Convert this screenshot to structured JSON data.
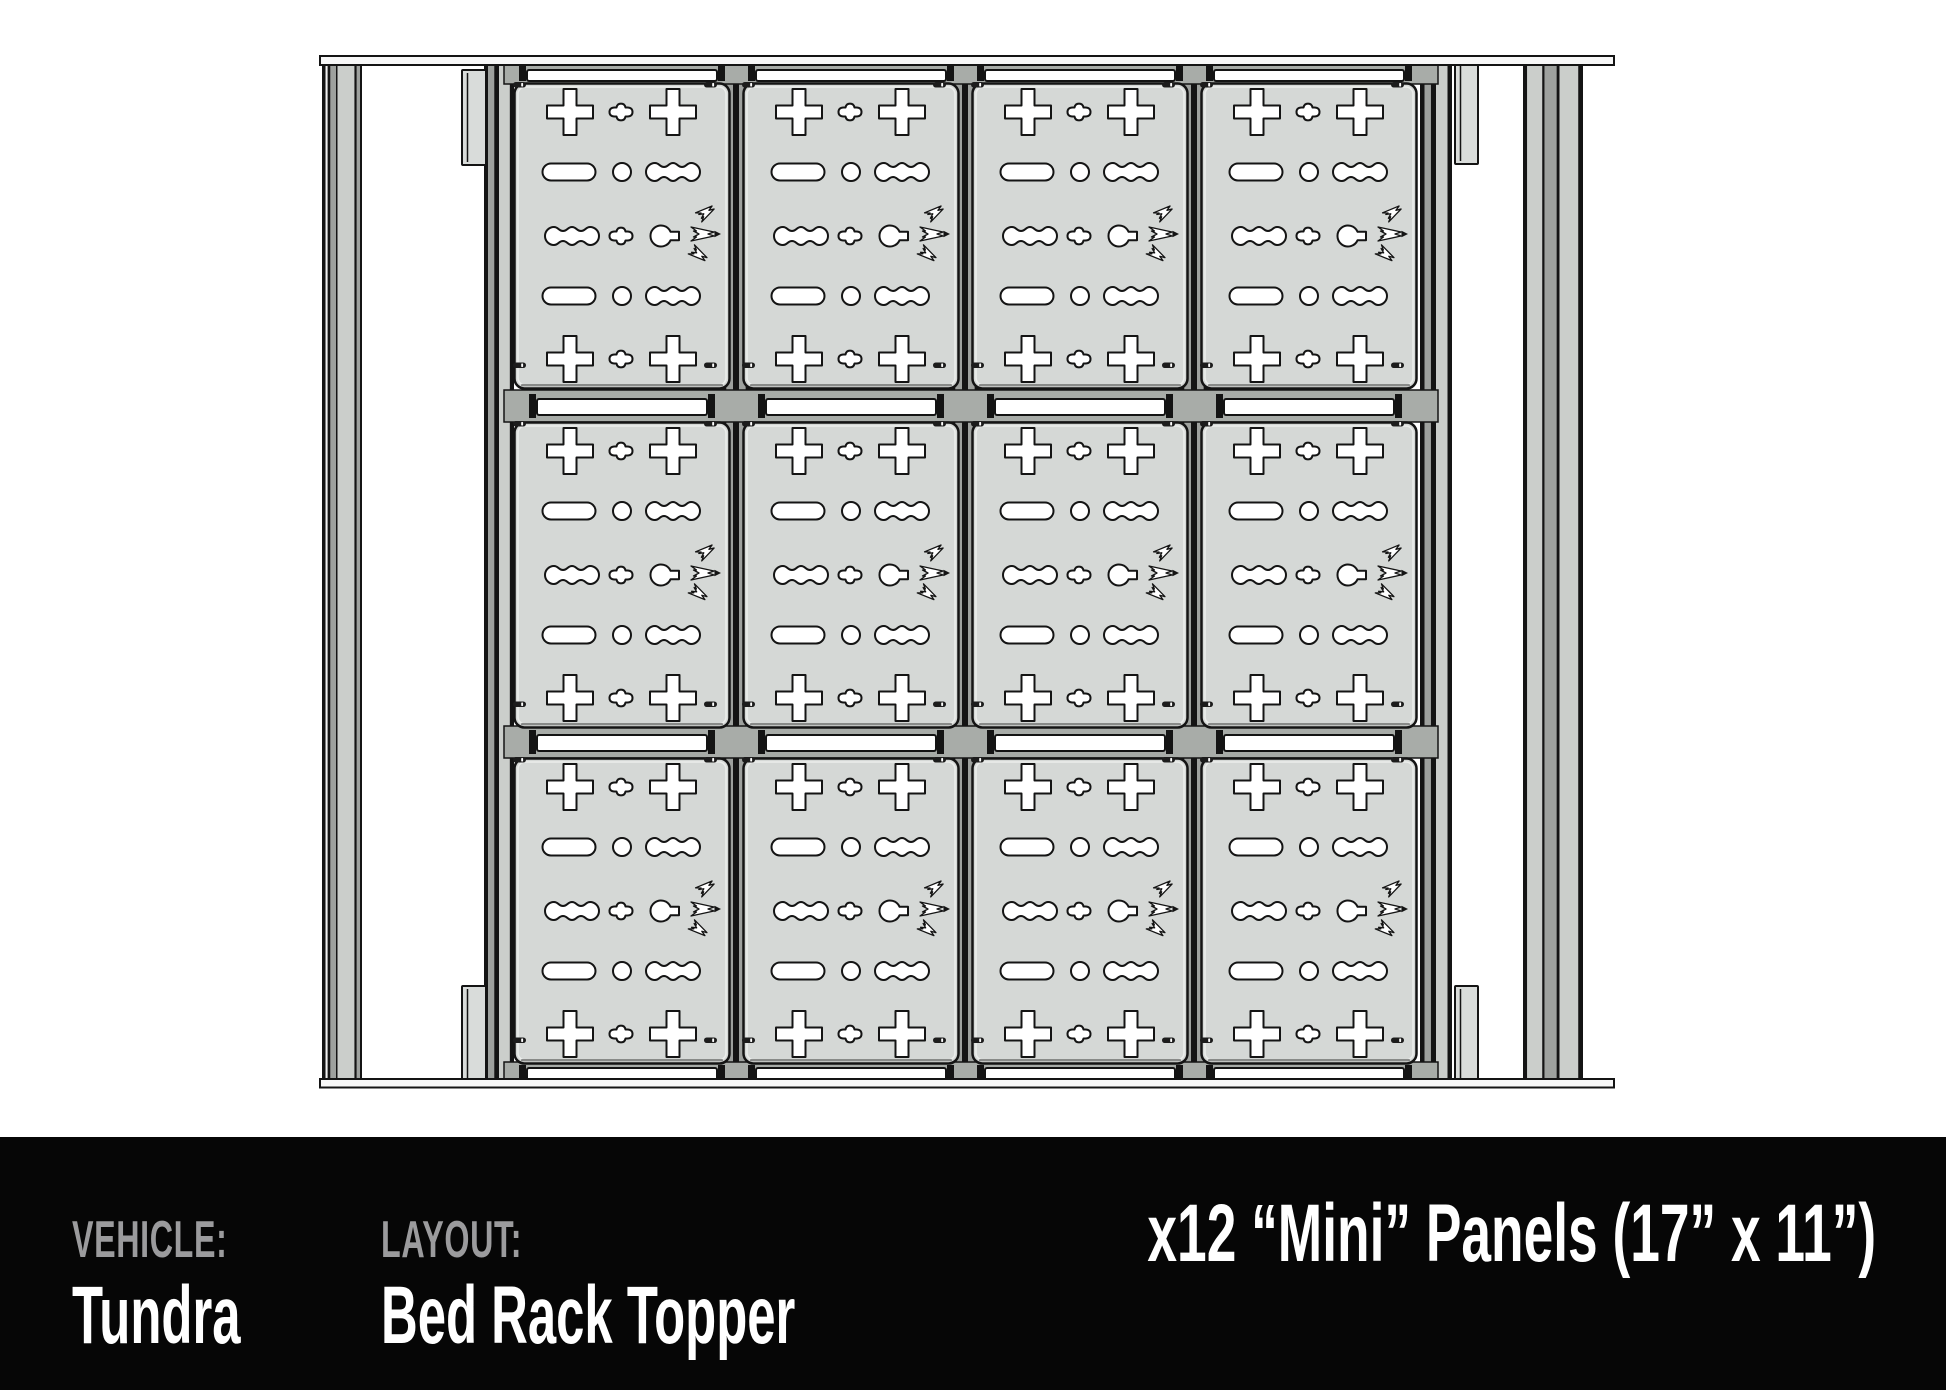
{
  "footer": {
    "vehicle_label": "VEHICLE:",
    "vehicle_value": "Tundra",
    "layout_label": "LAYOUT:",
    "layout_value": "Bed Rack Topper",
    "panel_info": "x12 “Mini” Panels (17” x 11”)"
  },
  "diagram": {
    "description": "Top view technical drawing of a truck bed rack topper fitted with accessory molle panels",
    "panel_grid": {
      "columns": 4,
      "rows": 3,
      "panel_count": 12,
      "panel_label": "Mini Panel",
      "panel_size": "17” x 11”"
    },
    "colors": {
      "panel_fill": "#d5d8d6",
      "outline": "#141414",
      "crossbar_gray": "#a8aca8",
      "rail_light": "#cbcecb",
      "rail_mid": "#9ea19e",
      "footer_bg": "#060606",
      "label_gray": "#9b9b9d",
      "text_white": "#ffffff"
    }
  }
}
